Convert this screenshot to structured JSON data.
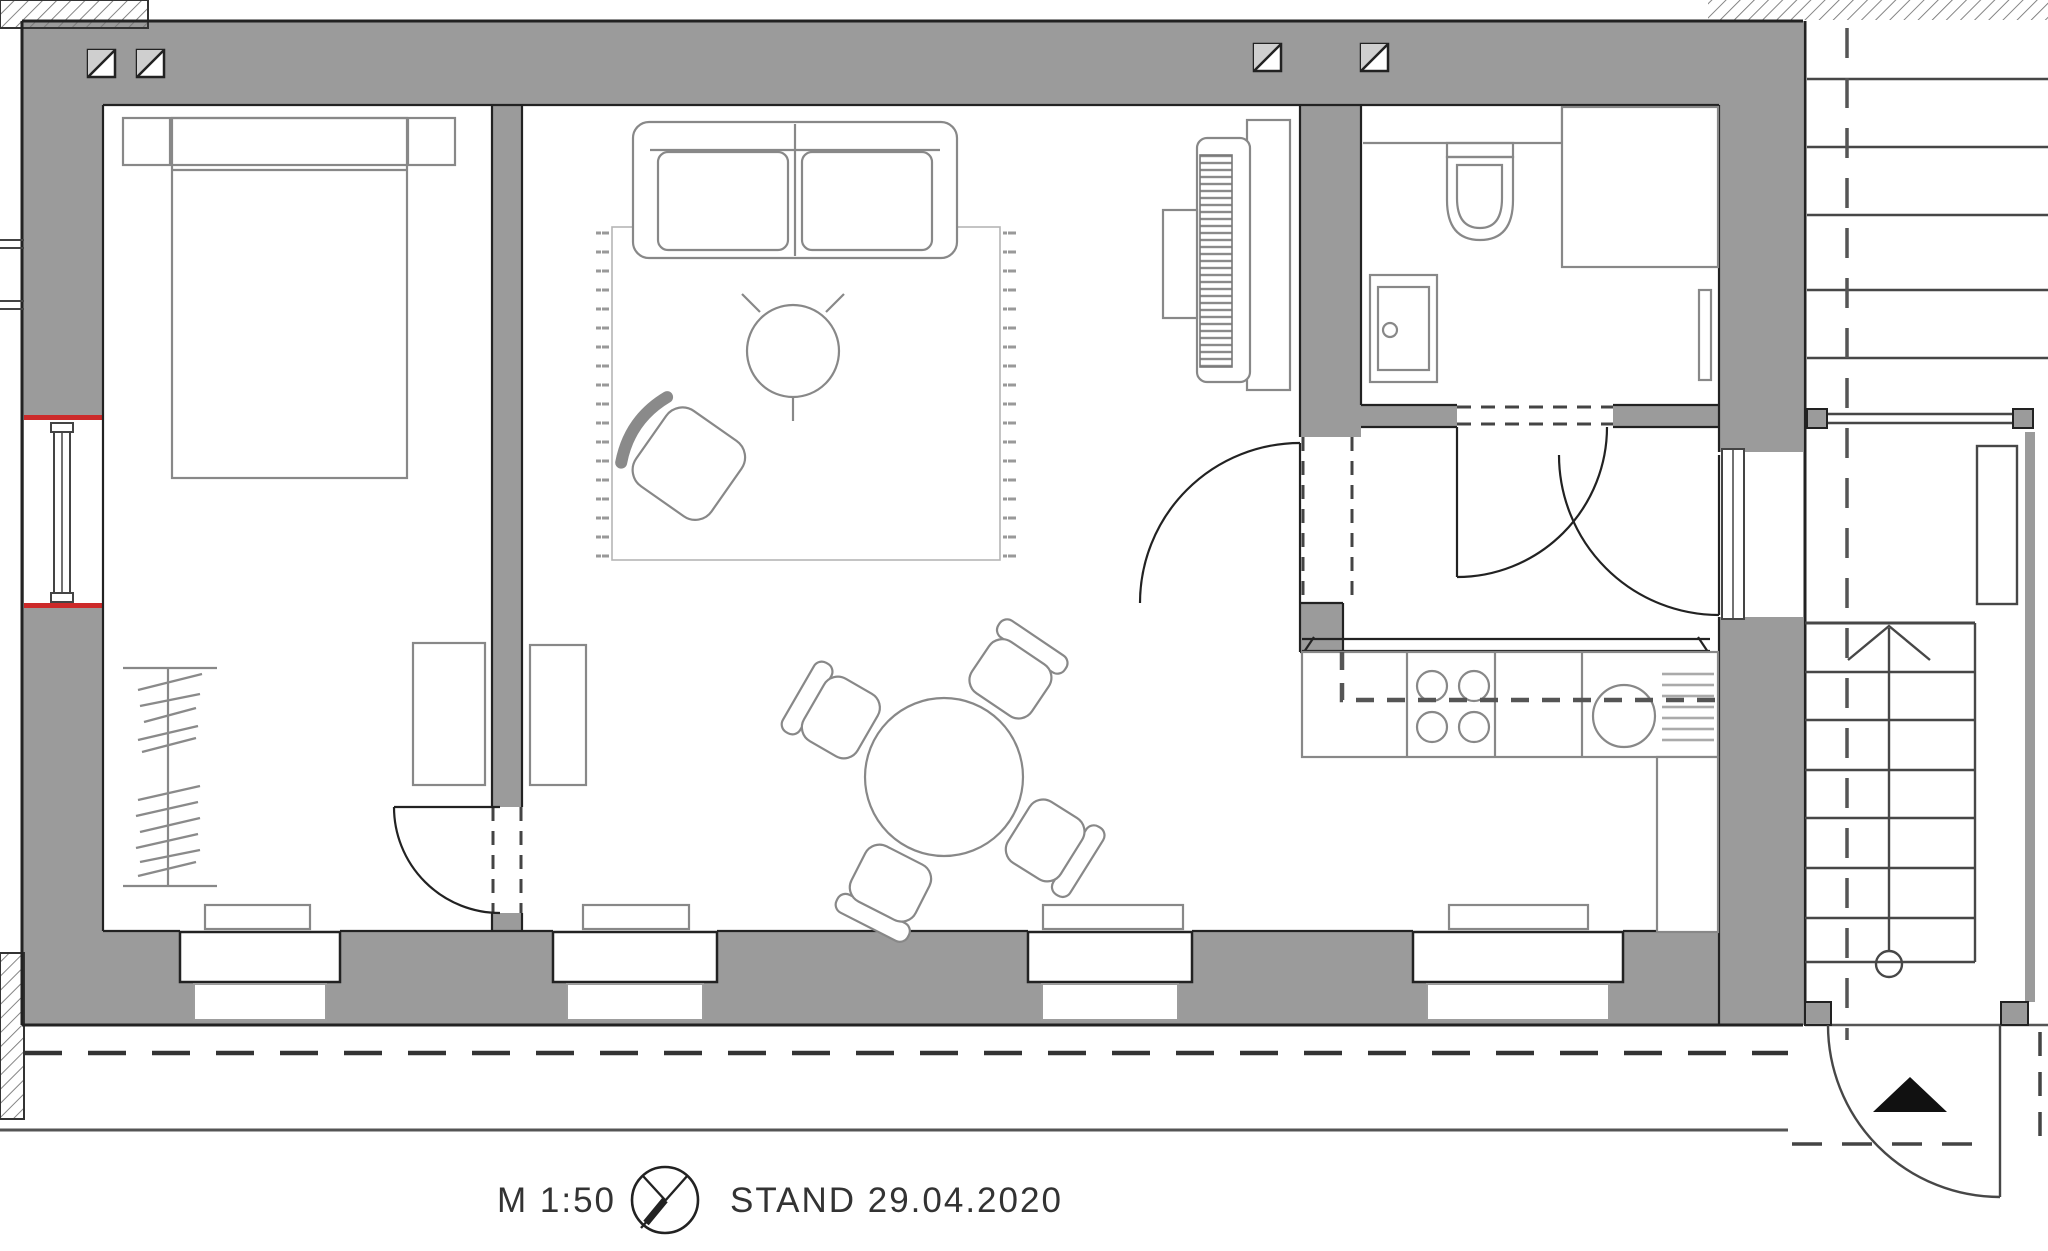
{
  "footer": {
    "scale_label": "M 1:50",
    "status_label": "STAND 29.04.2020"
  },
  "colors": {
    "wall_fill": "#9b9b9b",
    "outline": "#222222",
    "furniture_line": "#888888",
    "accent_red": "#cc2a2a",
    "background": "#ffffff",
    "text": "#333333"
  }
}
